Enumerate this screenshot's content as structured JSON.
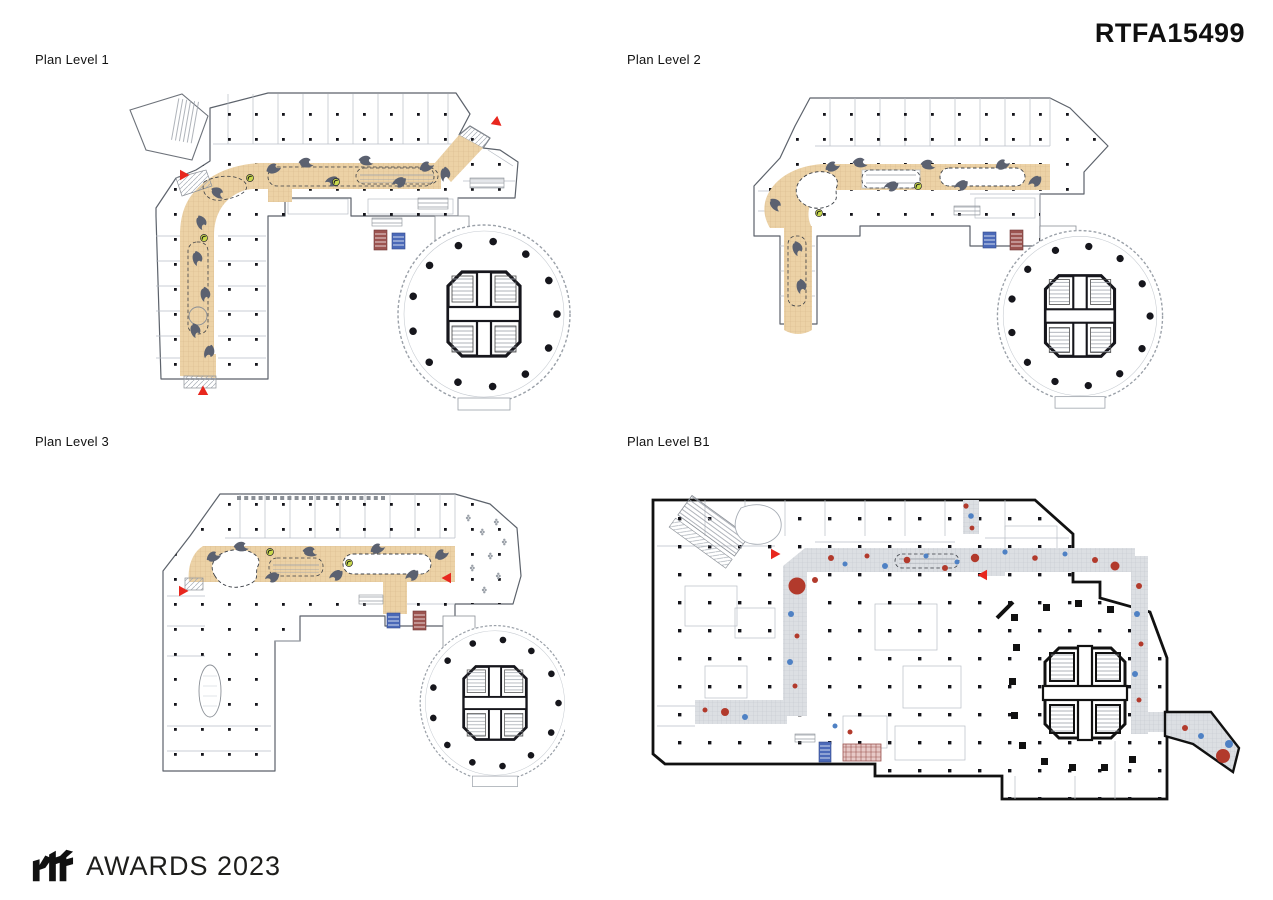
{
  "header": {
    "project_code": "RTFA15499"
  },
  "plans": [
    {
      "label": "Plan Level 1"
    },
    {
      "label": "Plan Level 2"
    },
    {
      "label": "Plan Level 3"
    },
    {
      "label": "Plan Level B1"
    }
  ],
  "footer": {
    "logo_text": "rtf",
    "awards_text": "AWARDS 2023"
  },
  "palette": {
    "paper": "#ffffff",
    "wall_dark": "#16161c",
    "wall_grey": "#8a8f96",
    "partition": "#b9bec6",
    "corridor_tan": "#ecd2a6",
    "corridor_grey": "#dcdfe3",
    "ribbon_grey": "#5b6170",
    "marker_red": "#e8271e",
    "dot_red": "#b23a2c",
    "dot_blue": "#4f81c4",
    "escalator_blue": "#4b69b8",
    "escalator_maroon": "#9c5450",
    "accent_green": "#c9d94d"
  }
}
